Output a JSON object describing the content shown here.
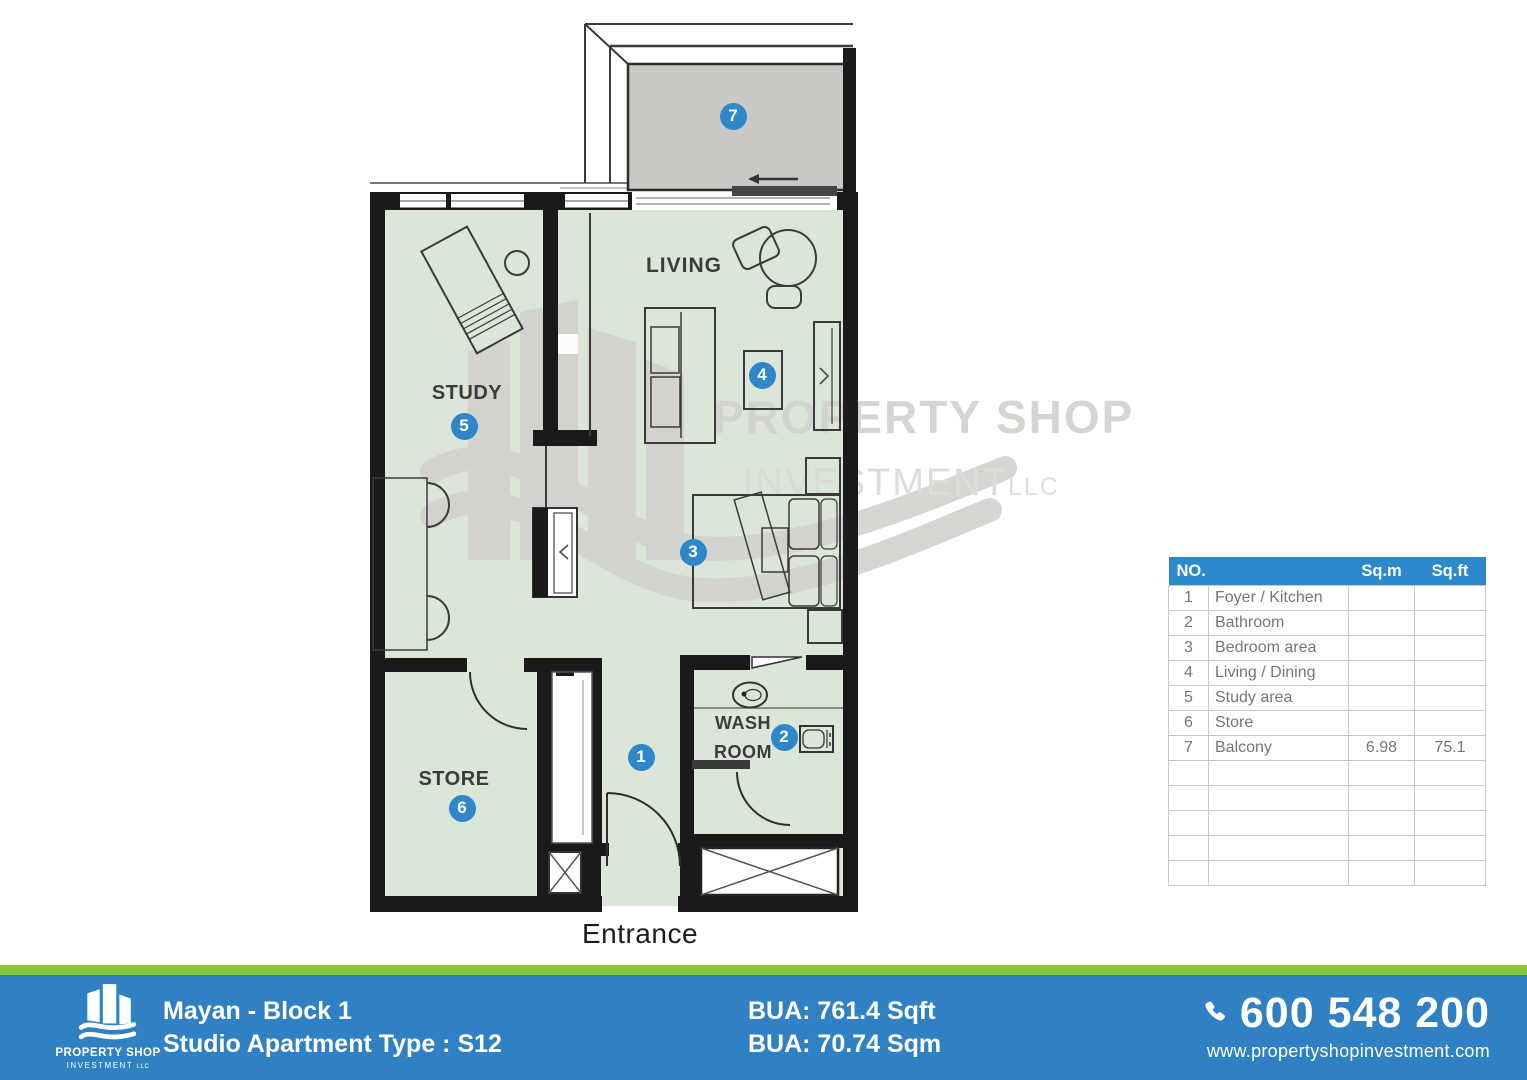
{
  "plan": {
    "rooms": {
      "living": "LIVING",
      "study": "STUDY",
      "store": "STORE",
      "washroom_line1": "WASH",
      "washroom_line2": "ROOM",
      "entrance": "Entrance"
    },
    "markers": [
      {
        "n": "1",
        "x": 641,
        "y": 757
      },
      {
        "n": "2",
        "x": 784,
        "y": 737
      },
      {
        "n": "3",
        "x": 693,
        "y": 552
      },
      {
        "n": "4",
        "x": 762,
        "y": 375
      },
      {
        "n": "5",
        "x": 464,
        "y": 426
      },
      {
        "n": "6",
        "x": 462,
        "y": 808
      },
      {
        "n": "7",
        "x": 733,
        "y": 116
      }
    ]
  },
  "watermark": {
    "line1": "PROPERTY SHOP",
    "line2": "INVESTMENT",
    "suffix": "LLC"
  },
  "table": {
    "headers": {
      "no": "NO.",
      "sqm": "Sq.m",
      "sqft": "Sq.ft"
    },
    "rows": [
      {
        "no": "1",
        "name": "Foyer / Kitchen",
        "sqm": "",
        "sqft": ""
      },
      {
        "no": "2",
        "name": "Bathroom",
        "sqm": "",
        "sqft": ""
      },
      {
        "no": "3",
        "name": "Bedroom area",
        "sqm": "",
        "sqft": ""
      },
      {
        "no": "4",
        "name": "Living / Dining",
        "sqm": "",
        "sqft": ""
      },
      {
        "no": "5",
        "name": "Study area",
        "sqm": "",
        "sqft": ""
      },
      {
        "no": "6",
        "name": "Store",
        "sqm": "",
        "sqft": ""
      },
      {
        "no": "7",
        "name": "Balcony",
        "sqm": "6.98",
        "sqft": "75.1"
      }
    ],
    "empty_rows": 5
  },
  "footer": {
    "logo": {
      "line1": "PROPERTY SHOP",
      "line2": "INVESTMENT",
      "suffix": "LLC"
    },
    "project": "Mayan - Block 1",
    "type": "Studio Apartment Type : S12",
    "bua_sqft": "BUA: 761.4 Sqft",
    "bua_sqm": "BUA: 70.74 Sqm",
    "phone": "600 548 200",
    "website": "www.propertyshopinvestment.com"
  },
  "colors": {
    "marker_blue": "#2e87c9",
    "table_header_blue": "#2c89cb",
    "footer_blue": "#2f81c4",
    "footer_green": "#8cc63f",
    "room_green": "#dbe6d8",
    "balcony_gray": "#c8c9c5",
    "watermark_gray": "#d2d2cf",
    "wall_black": "#1a1a1a"
  }
}
